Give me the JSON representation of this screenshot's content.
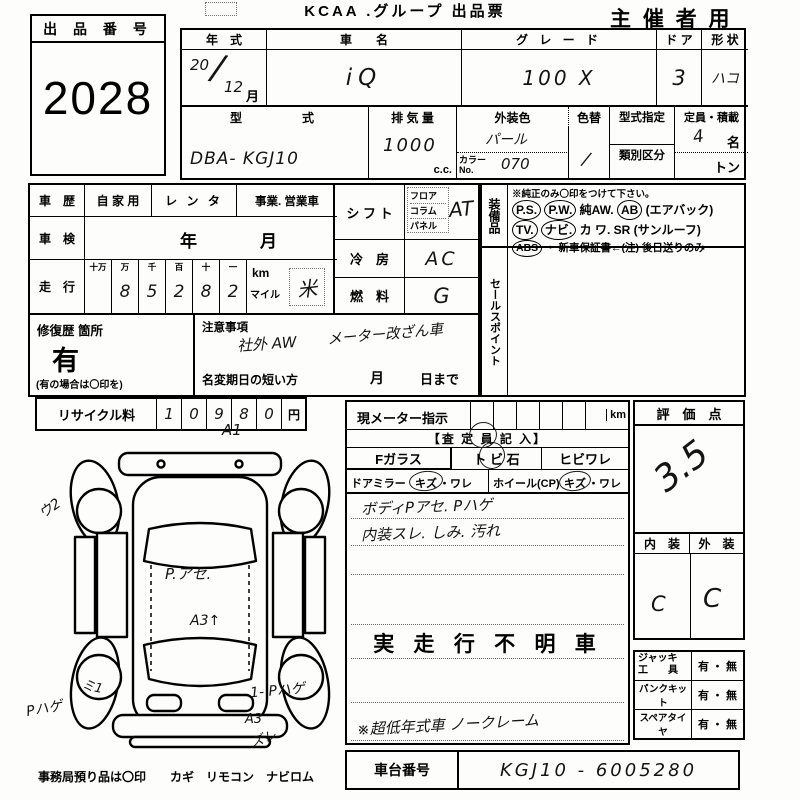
{
  "header": {
    "title": "KCAA .グループ 出品票",
    "audience": "主 催 者 用",
    "lot_label": "出 品 番 号",
    "lot_number": "2028"
  },
  "spec": {
    "year_label": "年　式",
    "year_top": "20",
    "year_slash": "/",
    "year_bottom": "12",
    "year_month": "月",
    "name_label": "車　　名",
    "name_value": "iQ",
    "grade_label": "グ レ ー ド",
    "grade_value": "100 X",
    "doors_label": "ド ア",
    "doors_value": "3",
    "shape_label": "形 状",
    "shape_value": "ハコ",
    "model_label": "型　　　式",
    "model_value": "DBA- KGJ10",
    "disp_label": "排 気 量",
    "disp_value": "1000",
    "disp_unit": "c.c.",
    "color_label": "外装色",
    "color_value": "パール",
    "color_no_label": "カラーNo.",
    "color_no_value": "070",
    "repaint_label": "色替",
    "repaint_value": "/",
    "type_approval_label": "型式指定",
    "class_label": "類別区分",
    "capacity_label": "定員・積載",
    "capacity_value": "4",
    "capacity_unit": "名",
    "load_unit": "トン"
  },
  "history": {
    "label": "車　歴",
    "options": [
      "自 家 用",
      "レ ン タ",
      "事業. 営業車"
    ],
    "inspection_label": "車　検",
    "inspection_year": "年",
    "inspection_month": "月",
    "mileage_label": "走　行",
    "digit_headers": [
      "十万",
      "万",
      "千",
      "百",
      "十",
      "一"
    ],
    "digit_values": [
      "",
      "8",
      "5",
      "2",
      "8",
      "2"
    ],
    "unit_km": "km",
    "unit_mile": "マイル",
    "unit_mark": "米"
  },
  "repair": {
    "label": "修復歴 箇所",
    "value": "有",
    "note": "(有の場合は〇印を)"
  },
  "caution": {
    "label": "注意事項",
    "line1": "社外 AW",
    "line2": "メーター改ざん車",
    "rename_label": "名変期日の短い方",
    "rename_month": "月",
    "rename_day": "日まで"
  },
  "recycle": {
    "label": "リサイクル料",
    "digits": [
      "1",
      "0",
      "9",
      "8",
      "0"
    ],
    "unit": "円"
  },
  "shift": {
    "label": "シ フ ト",
    "options": [
      "フロア",
      "コラム",
      "パネル"
    ],
    "value": "AT"
  },
  "aircon": {
    "label": "冷　房",
    "value": "AC"
  },
  "fuel": {
    "label": "燃　料",
    "value": "G"
  },
  "equipment": {
    "label": "装備品",
    "note": "※純正のみ〇印をつけて下さい。",
    "items": [
      {
        "t": "P.S.",
        "c": true
      },
      {
        "t": "P.W.",
        "c": true
      },
      {
        "t": "純AW.",
        "c": false
      },
      {
        "t": "AB",
        "c": true
      },
      {
        "t": "(エアバック)",
        "c": false
      },
      {
        "t": "TV.",
        "c": true
      },
      {
        "t": "ナビ.",
        "c": true
      },
      {
        "t": "カ ワ.",
        "c": false
      },
      {
        "t": "SR",
        "c": false
      },
      {
        "t": "(サンルーフ)",
        "c": false
      },
      {
        "t": "ABS",
        "c": true
      },
      {
        "t": "・ 新車保証書←(注) 後日送りのみ",
        "c": false
      }
    ]
  },
  "sales": {
    "label": "セールスポイント"
  },
  "meter": {
    "label": "現メーター指示",
    "unit": "km"
  },
  "assessor": {
    "header": "【査 定 員 記 入】",
    "glass": "Fガラス",
    "stone": "ト ビ 石",
    "crack": "ヒビワレ",
    "mirror_label": "ドアミラー",
    "kizu": "キズ",
    "ware": "・ワレ",
    "wheel_label": "ホイール(CP)",
    "note1": "ボディPアセ.  Pハゲ",
    "note2": "内装スレ. しみ. 汚れ",
    "stamp": "実 走 行 不 明 車",
    "note3": "※超低年式車  ノークレーム"
  },
  "score": {
    "label": "評　価　点",
    "value": "3.5",
    "interior_label": "内　装",
    "exterior_label": "外　装",
    "interior_value": "C",
    "exterior_value": "C"
  },
  "tools": {
    "rows": [
      {
        "l1": "ジャッキ",
        "l2": "工　　具",
        "v": "有 ・ 無"
      },
      {
        "l1": "パンクキット",
        "l2": "",
        "v": "有 ・ 無"
      },
      {
        "l1": "スペアタイヤ",
        "l2": "",
        "v": "有 ・ 無"
      }
    ]
  },
  "chassis": {
    "label": "車台番号",
    "value": "KGJ10 - 6005280"
  },
  "diagram": {
    "a1": "A1",
    "u2": "ウ2",
    "p_ase": "P.アセ.",
    "a3": "A3↑",
    "mi1": "ミ1",
    "p_hage_left": "Pハゲ",
    "p_hage_right": "1- Pハゲ",
    "a3b": "A3",
    "zure": "ズレ"
  },
  "footer": {
    "note": "事務局預り品は〇印　　カギ　リモコン　ナビロム"
  }
}
